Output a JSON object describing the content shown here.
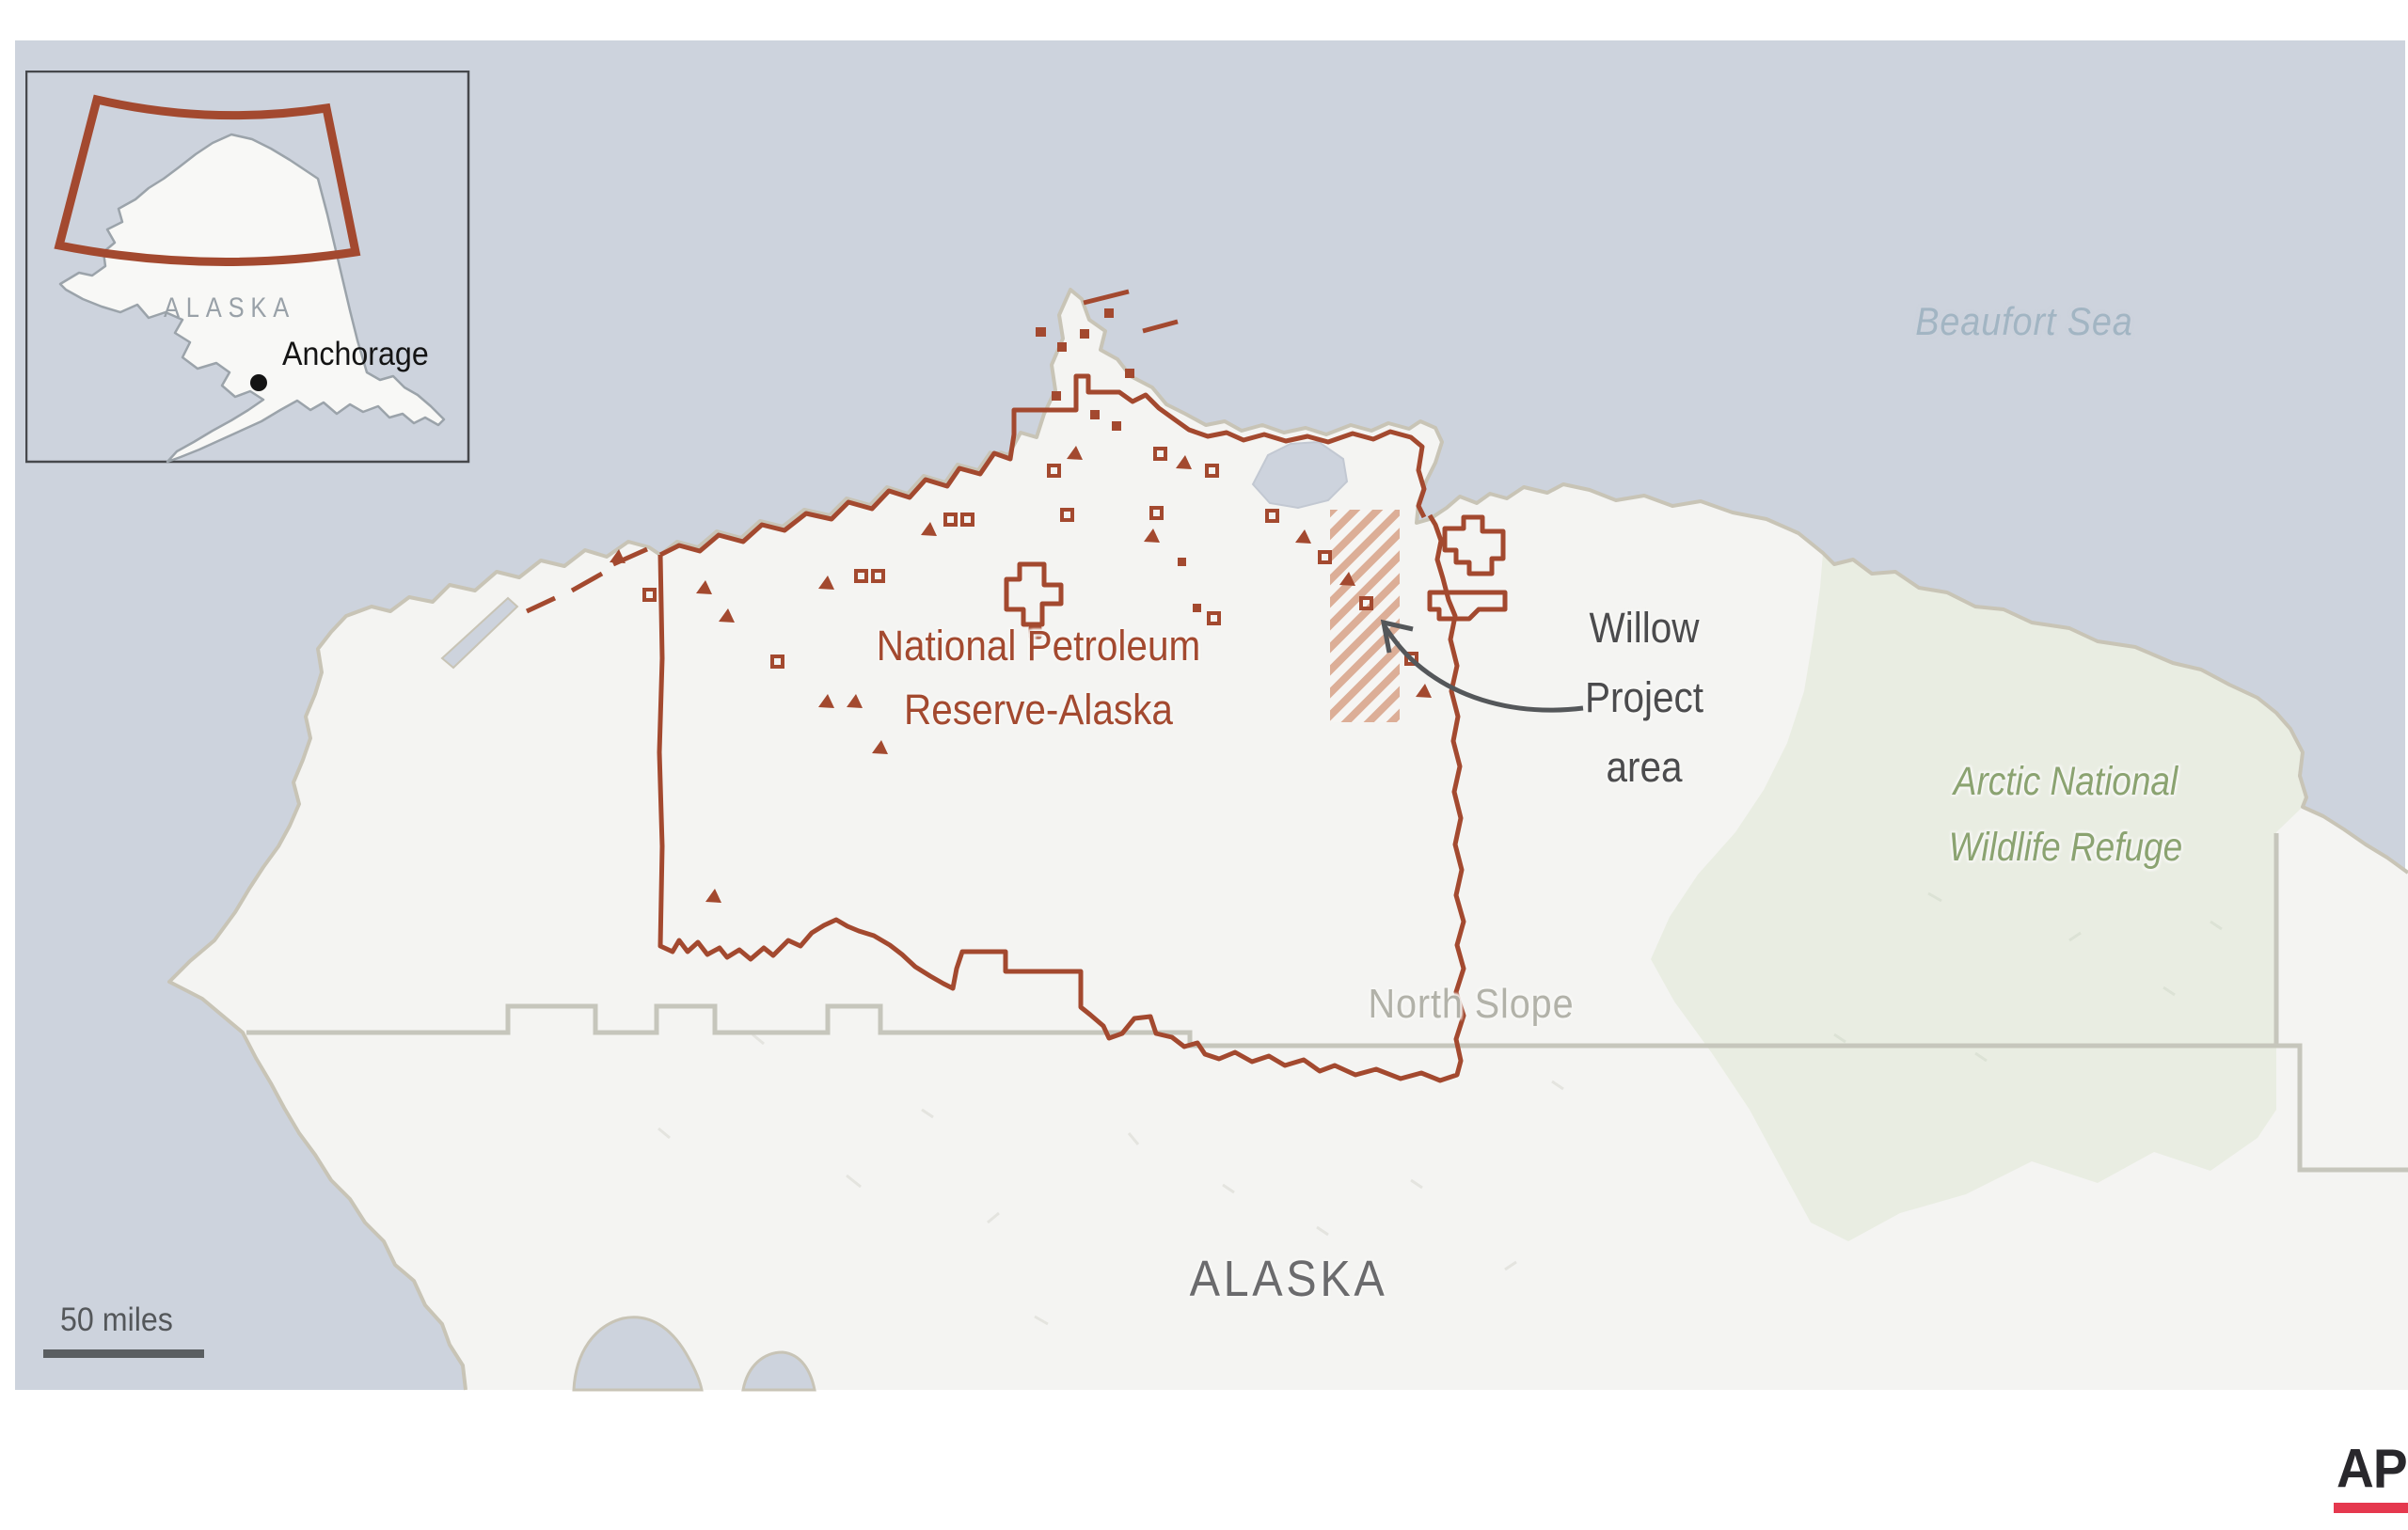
{
  "map": {
    "sea_label": "Beaufort Sea",
    "reserve_label_line1": "National Petroleum",
    "reserve_label_line2": "Reserve-Alaska",
    "willow_label_line1": "Willow",
    "willow_label_line2": "Project",
    "willow_label_line3": "area",
    "refuge_label_line1": "Arctic National",
    "refuge_label_line2": "Wildlife Refuge",
    "borough_label": "North Slope",
    "state_label": "ALASKA",
    "scale_label": "50 miles",
    "icons": {
      "leader_arrow": "curved-arrow-pointing-to-willow-area",
      "city_marker": "filled-dot"
    },
    "colors": {
      "sea": "#cdd3dd",
      "land": "#f4f4f2",
      "coastline": "#c8c4b6",
      "reserve_boundary": "#a3492f",
      "willow_hatch": "#dcae97",
      "refuge_fill": "#e9ede2",
      "refuge_text": "#8ba371",
      "borough_boundary": "#c6c6bc",
      "borough_text": "#b2b2a9",
      "sea_text": "#a2b5c3",
      "label_dark": "#4b4b4d",
      "arrow": "#54575a"
    }
  },
  "inset": {
    "state_label": "ALASKA",
    "city_label": "Anchorage",
    "extent_box_color": "#a3492f"
  },
  "logo": {
    "text": "AP",
    "bar_color": "#e5384e"
  }
}
